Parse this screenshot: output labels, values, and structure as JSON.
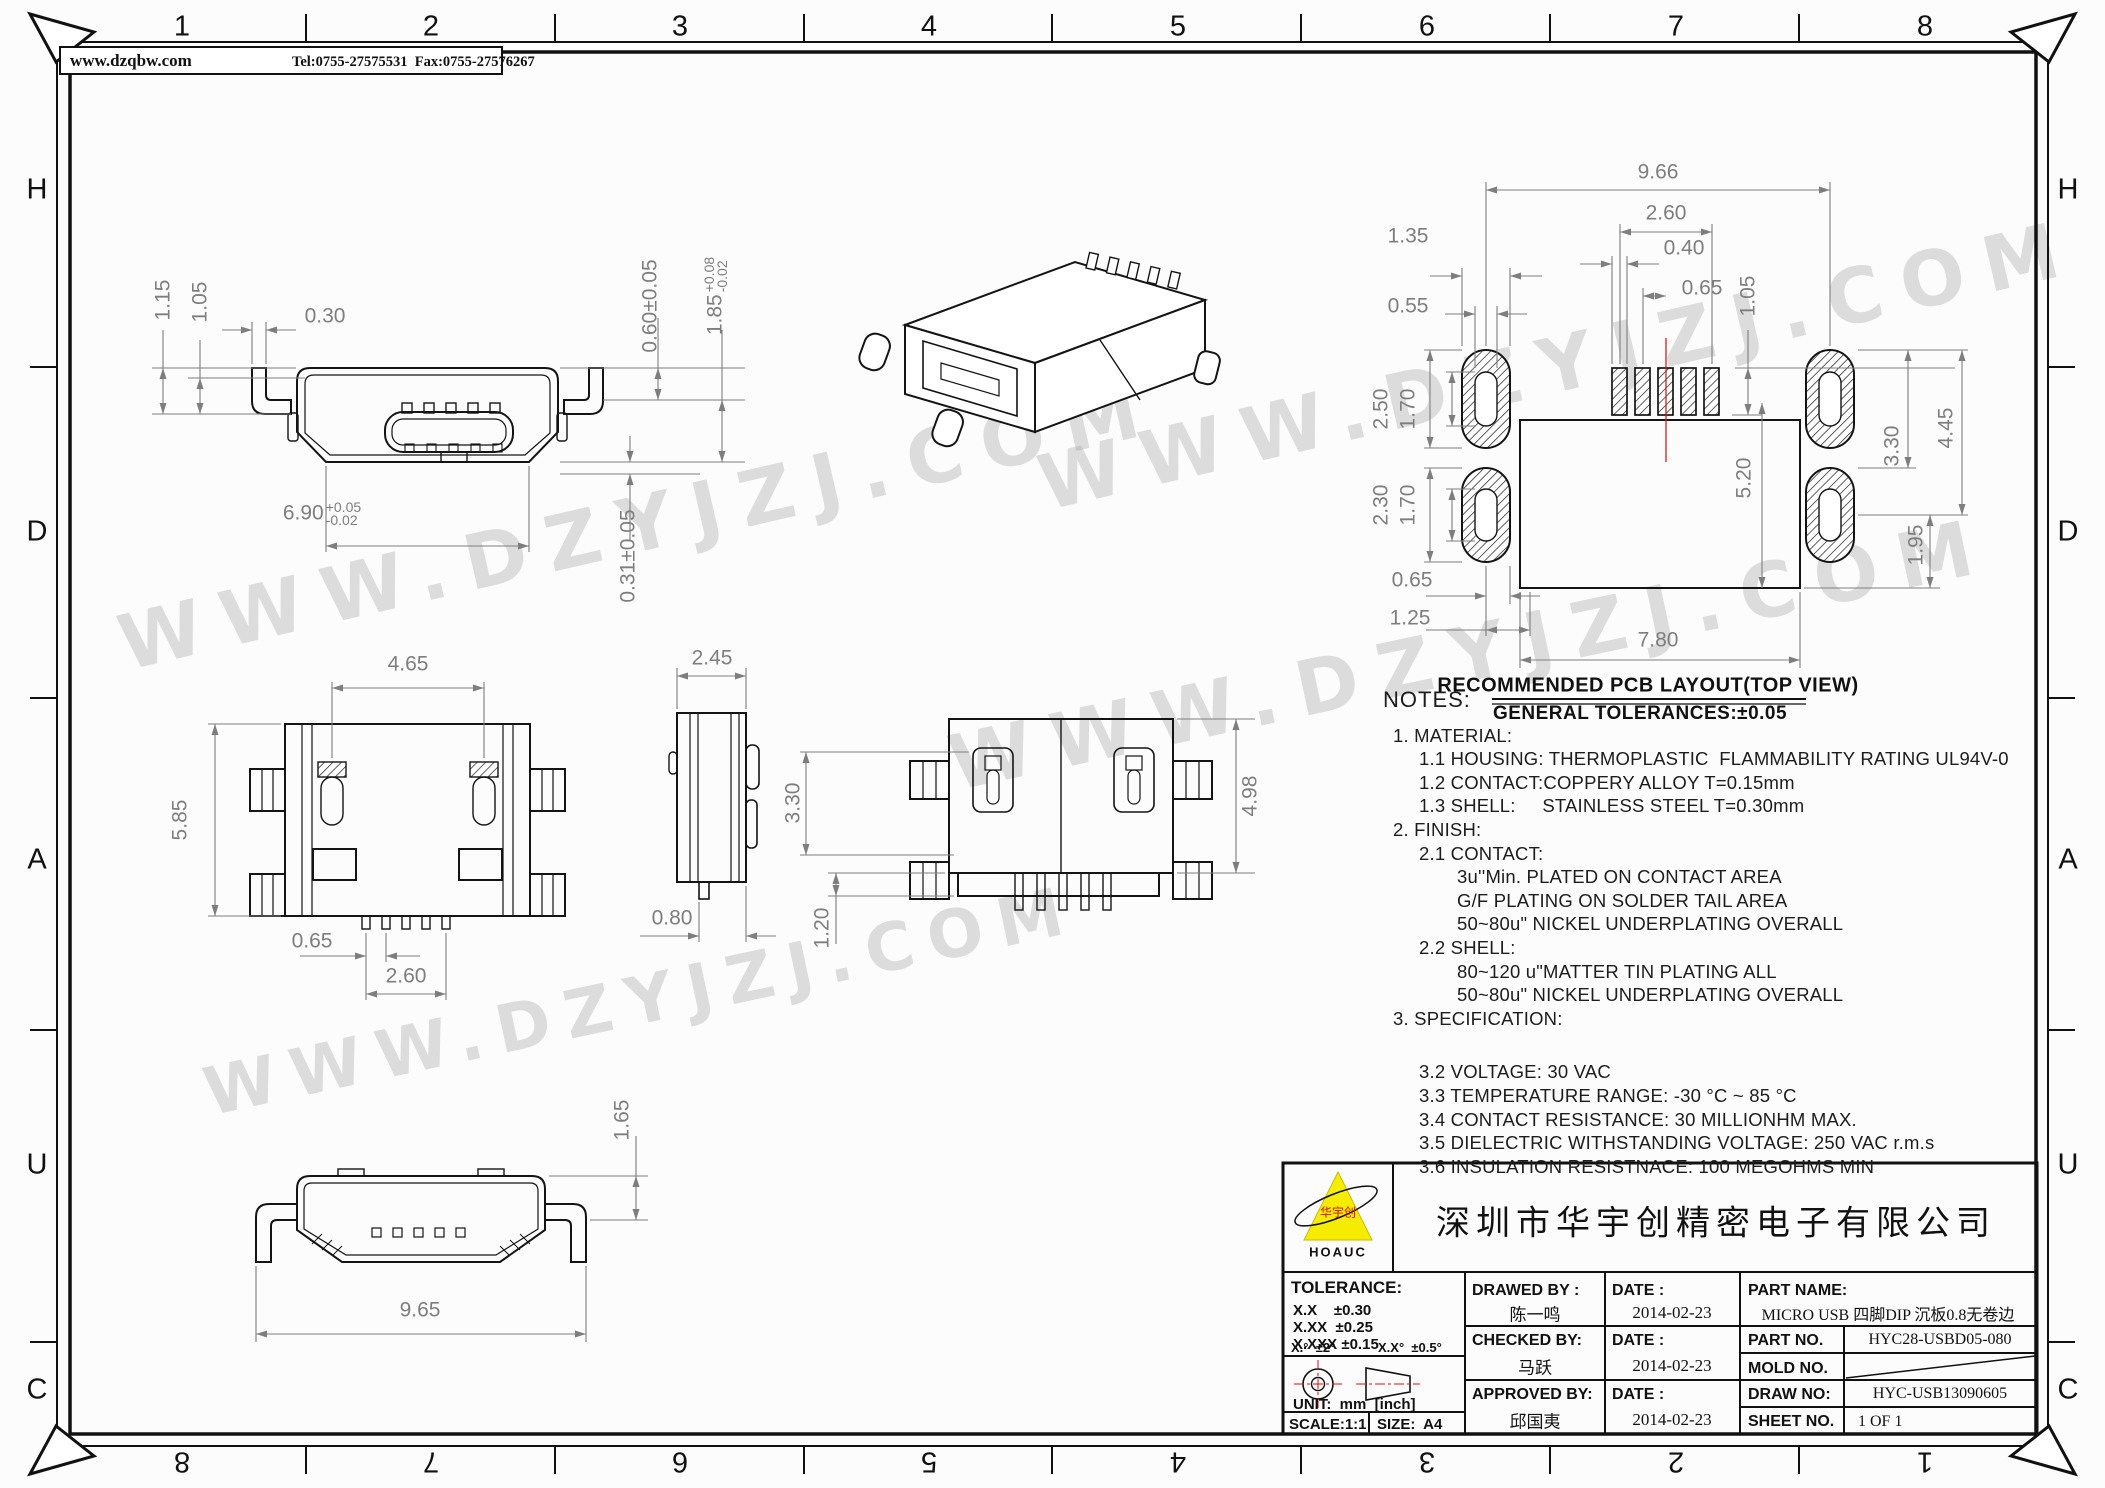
{
  "watermark": {
    "text": "WWW.DZYJZJ.COM"
  },
  "header": {
    "site": "www.dzqbw.com",
    "contact": "Tel:0755-27575531  Fax:0755-27576267"
  },
  "border": {
    "top_numbers": [
      "1",
      "2",
      "3",
      "4",
      "5",
      "6",
      "7",
      "8"
    ],
    "bottom_numbers": [
      "8",
      "7",
      "6",
      "5",
      "4",
      "3",
      "2",
      "1"
    ],
    "side_letters": [
      "H",
      "D",
      "A",
      "U",
      "C"
    ]
  },
  "front_view": {
    "d115": "1.15",
    "d105": "1.05",
    "d030": "0.30",
    "d060": "0.60±0.05",
    "d185": "1.85",
    "d185tp": "+0.08",
    "d185tm": "-0.02",
    "d031": "0.31±0.05",
    "d690": "6.90",
    "d690tp": "+0.05",
    "d690tm": "-0.02"
  },
  "top_view": {
    "d465": "4.65",
    "d585": "5.85",
    "d065": "0.65",
    "d260": "2.60"
  },
  "side_view": {
    "d245": "2.45",
    "d080": "0.80"
  },
  "bottom_view": {
    "d330": "3.30",
    "d120": "1.20",
    "d498": "4.98"
  },
  "rear_view": {
    "d165": "1.65",
    "d965": "9.65"
  },
  "pcb": {
    "d966": "9.66",
    "d260": "2.60",
    "d040": "0.40",
    "d065a": "0.65",
    "d135": "1.35",
    "d055": "0.55",
    "d105": "1.05",
    "d250": "2.50",
    "d170a": "1.70",
    "d230": "2.30",
    "d170b": "1.70",
    "d065b": "0.65",
    "d125": "1.25",
    "d780": "7.80",
    "d520": "5.20",
    "d330": "3.30",
    "d445": "4.45",
    "d195": "1.95",
    "title": "RECOMMENDED PCB LAYOUT(TOP VIEW)",
    "subtitle": "GENERAL TOLERANCES:±0.05"
  },
  "notes": {
    "title": "NOTES:",
    "lines": [
      "1. MATERIAL:",
      "1.1 HOUSING: THERMOPLASTIC  FLAMMABILITY RATING UL94V-0",
      "1.2 CONTACT:COPPERY ALLOY T=0.15mm",
      "1.3 SHELL:     STAINLESS STEEL T=0.30mm",
      "2. FINISH:",
      "2.1 CONTACT:",
      "3u''Min. PLATED ON CONTACT AREA",
      "G/F PLATING ON SOLDER TAIL AREA",
      "50~80u\" NICKEL UNDERPLATING OVERALL",
      "2.2 SHELL:",
      "80~120 u\"MATTER TIN PLATING ALL",
      "50~80u\" NICKEL UNDERPLATING OVERALL",
      "3. SPECIFICATION:",
      "",
      "3.2 VOLTAGE: 30 VAC",
      "3.3 TEMPERATURE RANGE: -30 °C ~ 85 °C",
      "3.4 CONTACT RESISTANCE: 30 MILLIONHM MAX.",
      "3.5 DIELECTRIC WITHSTANDING VOLTAGE: 250 VAC r.m.s",
      "3.6 INSULATION RESISTNACE: 100 MEGOHMS MIN"
    ]
  },
  "titleblock": {
    "company": "深圳市华宇创精密电子有限公司",
    "logo_text": "华宇创",
    "logo_sub": "HOAUC",
    "tolerance_title": "TOLERANCE:",
    "tol1": "X.X    ±0.30",
    "tol2": "X.XX  ±0.25",
    "tol3": "X.XXX ±0.15",
    "ang1": "X.°  ±2°",
    "ang2": "X.X°  ±0.5°",
    "unit": "UNIT:  mm  [inch]",
    "scale": "SCALE:1:1",
    "size": "SIZE:  A4",
    "drawed_label": "DRAWED BY :",
    "date_label": "DATE :",
    "drawed_name": "陈一鸣",
    "date1": "2014-02-23",
    "checked_label": "CHECKED BY:",
    "checked_name": "马跃",
    "date2": "2014-02-23",
    "approved_label": "APPROVED BY:",
    "approved_name": "邱国夷",
    "date3": "2014-02-23",
    "part_name_label": "PART NAME:",
    "part_name": "MICRO USB 四脚DIP 沉板0.8无卷边",
    "part_no_label": "PART NO.",
    "part_no": "HYC28-USBD05-080",
    "mold_label": "MOLD NO.",
    "draw_label": "DRAW NO:",
    "draw_no": "HYC-USB13090605",
    "sheet_label": "SHEET NO.",
    "sheet_no": "1 OF 1"
  }
}
